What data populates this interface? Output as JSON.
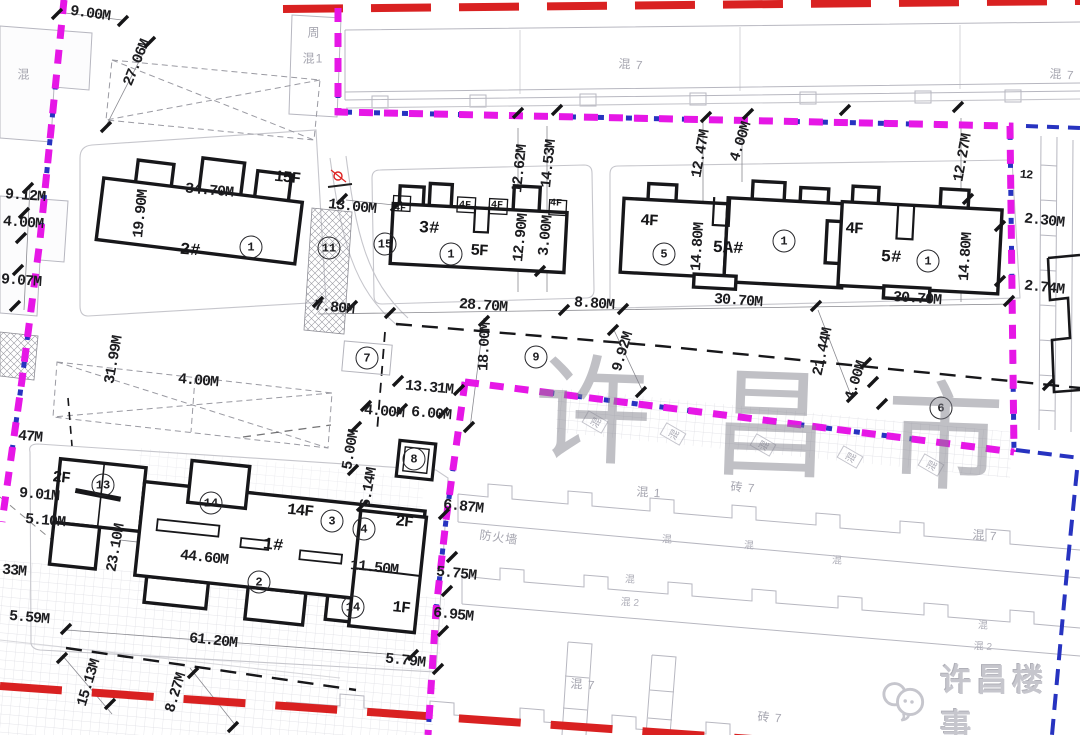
{
  "colors": {
    "boundary_magenta": "#e617e6",
    "boundary_blue": "#2733c0",
    "road_red": "#d92121",
    "drawing_black": "#17171a",
    "existing_gray": "#b4b4bc",
    "watermark_gray": "rgba(130,130,140,0.5)"
  },
  "watermark": {
    "text": "许昌市"
  },
  "logo": {
    "text": "许昌楼事",
    "icon": "chat-bubbles-icon"
  },
  "buildings": [
    {
      "number": "1#",
      "floors": [
        "14F",
        "2F",
        "1F"
      ],
      "length": "61.20M",
      "width": "23.10M"
    },
    {
      "number": "2#",
      "floors": [
        "15F"
      ],
      "length": "34.70M",
      "width": "19.90M"
    },
    {
      "number": "3#",
      "floors": [
        "5F",
        "4F"
      ],
      "length": "28.70M",
      "width": "12.90M"
    },
    {
      "number": "5A#",
      "floors": [
        "4F"
      ],
      "length": "30.70M",
      "width": "14.80M"
    },
    {
      "number": "5#",
      "floors": [
        "4F"
      ],
      "length": "30.70M",
      "width": "14.80M"
    }
  ],
  "plan": {
    "labels": [
      {
        "t": "9.00M",
        "x": 90,
        "y": 14,
        "r": 8,
        "c": "dim"
      },
      {
        "t": "27.06M",
        "x": 137,
        "y": 63,
        "r": -68,
        "c": "dim"
      },
      {
        "t": "9.12M",
        "x": 25,
        "y": 196,
        "r": 4,
        "c": "dim"
      },
      {
        "t": "4.00M",
        "x": 23,
        "y": 223,
        "r": 4,
        "c": "dim"
      },
      {
        "t": "9.07M",
        "x": 21,
        "y": 281,
        "r": 4,
        "c": "dim"
      },
      {
        "t": "19.90M",
        "x": 141,
        "y": 214,
        "r": -84,
        "c": "dim"
      },
      {
        "t": "34.70M",
        "x": 209,
        "y": 191,
        "r": 5,
        "c": "dim"
      },
      {
        "t": "15F",
        "x": 287,
        "y": 178,
        "r": 6,
        "c": "floor"
      },
      {
        "t": "2#",
        "x": 190,
        "y": 251,
        "r": 5,
        "c": "bld"
      },
      {
        "t": "13.00M",
        "x": 352,
        "y": 207,
        "r": 6,
        "c": "dim"
      },
      {
        "t": "7.80M",
        "x": 334,
        "y": 308,
        "r": 6,
        "c": "dim"
      },
      {
        "t": "3#",
        "x": 429,
        "y": 229,
        "r": 3,
        "c": "bld"
      },
      {
        "t": "5F",
        "x": 479,
        "y": 251,
        "r": 3,
        "c": "floor"
      },
      {
        "t": "4F",
        "x": 400,
        "y": 209,
        "r": 3,
        "c": "f4"
      },
      {
        "t": "4F",
        "x": 465,
        "y": 206,
        "r": 3,
        "c": "f4"
      },
      {
        "t": "4F",
        "x": 497,
        "y": 206,
        "r": 3,
        "c": "f4"
      },
      {
        "t": "4F",
        "x": 556,
        "y": 204,
        "r": 3,
        "c": "f4"
      },
      {
        "t": "12.62M",
        "x": 520,
        "y": 169,
        "r": -84,
        "c": "dim"
      },
      {
        "t": "14.53M",
        "x": 549,
        "y": 164,
        "r": -84,
        "c": "dim"
      },
      {
        "t": "12.90M",
        "x": 521,
        "y": 238,
        "r": -84,
        "c": "dim"
      },
      {
        "t": "3.00M",
        "x": 546,
        "y": 236,
        "r": -84,
        "c": "dim"
      },
      {
        "t": "28.70M",
        "x": 483,
        "y": 306,
        "r": 4,
        "c": "dim"
      },
      {
        "t": "8.80M",
        "x": 594,
        "y": 304,
        "r": 4,
        "c": "dim"
      },
      {
        "t": "12.47M",
        "x": 701,
        "y": 154,
        "r": -80,
        "c": "dim"
      },
      {
        "t": "4.00M",
        "x": 741,
        "y": 142,
        "r": -72,
        "c": "dim"
      },
      {
        "t": "4F",
        "x": 649,
        "y": 221,
        "r": 3,
        "c": "floor"
      },
      {
        "t": "5A#",
        "x": 728,
        "y": 249,
        "r": 3,
        "c": "bld"
      },
      {
        "t": "14.80M",
        "x": 698,
        "y": 247,
        "r": -86,
        "c": "dim"
      },
      {
        "t": "30.70M",
        "x": 738,
        "y": 301,
        "r": 4,
        "c": "dim"
      },
      {
        "t": "4F",
        "x": 854,
        "y": 229,
        "r": 3,
        "c": "floor"
      },
      {
        "t": "5#",
        "x": 891,
        "y": 258,
        "r": 3,
        "c": "bld"
      },
      {
        "t": "14.80M",
        "x": 966,
        "y": 257,
        "r": -86,
        "c": "dim"
      },
      {
        "t": "12.27M",
        "x": 963,
        "y": 158,
        "r": -80,
        "c": "dim"
      },
      {
        "t": "30.70M",
        "x": 917,
        "y": 299,
        "r": 4,
        "c": "dim"
      },
      {
        "t": "2.30M",
        "x": 1044,
        "y": 221,
        "r": 6,
        "c": "dim"
      },
      {
        "t": "2.74M",
        "x": 1044,
        "y": 288,
        "r": 6,
        "c": "dim"
      },
      {
        "t": "12",
        "x": 1026,
        "y": 175,
        "r": 5,
        "c": "dimsm"
      },
      {
        "t": "18.00M",
        "x": 485,
        "y": 347,
        "r": -87,
        "c": "dim"
      },
      {
        "t": "9.92M",
        "x": 623,
        "y": 352,
        "r": -73,
        "c": "dim"
      },
      {
        "t": "21.44M",
        "x": 823,
        "y": 352,
        "r": -78,
        "c": "dim"
      },
      {
        "t": "4.00M",
        "x": 856,
        "y": 381,
        "r": -72,
        "c": "dim"
      },
      {
        "t": "13.31M",
        "x": 429,
        "y": 388,
        "r": 5,
        "c": "dim"
      },
      {
        "t": "31.99M",
        "x": 114,
        "y": 360,
        "r": -80,
        "c": "dim"
      },
      {
        "t": "4.00M",
        "x": 198,
        "y": 381,
        "r": 5,
        "c": "dim"
      },
      {
        "t": "47M",
        "x": 30,
        "y": 437,
        "r": 5,
        "c": "dim"
      },
      {
        "t": "4.00M",
        "x": 384,
        "y": 412,
        "r": 5,
        "c": "dim"
      },
      {
        "t": "6.00M",
        "x": 431,
        "y": 414,
        "r": 5,
        "c": "dim"
      },
      {
        "t": "5.00M",
        "x": 351,
        "y": 450,
        "r": -80,
        "c": "dim"
      },
      {
        "t": "6.14M",
        "x": 369,
        "y": 488,
        "r": -80,
        "c": "dim"
      },
      {
        "t": "6.87M",
        "x": 463,
        "y": 507,
        "r": 6,
        "c": "dim"
      },
      {
        "t": "防火墙",
        "x": 499,
        "y": 537,
        "r": 8,
        "c": "gray"
      },
      {
        "t": "5.75M",
        "x": 456,
        "y": 574,
        "r": 6,
        "c": "dim"
      },
      {
        "t": "6.95M",
        "x": 453,
        "y": 615,
        "r": 6,
        "c": "dim"
      },
      {
        "t": "5.79M",
        "x": 405,
        "y": 661,
        "r": 6,
        "c": "dim"
      },
      {
        "t": "2F",
        "x": 61,
        "y": 478,
        "r": 6,
        "c": "floor"
      },
      {
        "t": "9.01M",
        "x": 39,
        "y": 495,
        "r": 5,
        "c": "dim"
      },
      {
        "t": "5.10M",
        "x": 45,
        "y": 521,
        "r": 5,
        "c": "dim"
      },
      {
        "t": "33M",
        "x": 14,
        "y": 571,
        "r": 5,
        "c": "dim"
      },
      {
        "t": "5.59M",
        "x": 29,
        "y": 618,
        "r": 5,
        "c": "dim"
      },
      {
        "t": "23.10M",
        "x": 116,
        "y": 548,
        "r": -80,
        "c": "dim"
      },
      {
        "t": "14F",
        "x": 300,
        "y": 511,
        "r": 6,
        "c": "floor"
      },
      {
        "t": "2F",
        "x": 404,
        "y": 522,
        "r": 6,
        "c": "floor"
      },
      {
        "t": "1#",
        "x": 273,
        "y": 546,
        "r": 6,
        "c": "bld"
      },
      {
        "t": "44.60M",
        "x": 204,
        "y": 558,
        "r": 6,
        "c": "dim"
      },
      {
        "t": "11.50M",
        "x": 374,
        "y": 568,
        "r": 6,
        "c": "dim"
      },
      {
        "t": "1F",
        "x": 401,
        "y": 608,
        "r": 6,
        "c": "floor"
      },
      {
        "t": "61.20M",
        "x": 213,
        "y": 641,
        "r": 6,
        "c": "dim"
      },
      {
        "t": "15.13M",
        "x": 89,
        "y": 683,
        "r": -73,
        "c": "dim"
      },
      {
        "t": "8.27M",
        "x": 176,
        "y": 693,
        "r": -73,
        "c": "dim"
      },
      {
        "t": "1",
        "x": 251,
        "y": 247,
        "r": 0,
        "c": "circ"
      },
      {
        "t": "11",
        "x": 329,
        "y": 248,
        "r": 0,
        "c": "circ"
      },
      {
        "t": "15",
        "x": 385,
        "y": 244,
        "r": 0,
        "c": "circ"
      },
      {
        "t": "1",
        "x": 451,
        "y": 254,
        "r": 0,
        "c": "circ"
      },
      {
        "t": "5",
        "x": 664,
        "y": 254,
        "r": 0,
        "c": "circ"
      },
      {
        "t": "1",
        "x": 784,
        "y": 241,
        "r": 0,
        "c": "circ"
      },
      {
        "t": "1",
        "x": 928,
        "y": 261,
        "r": 0,
        "c": "circ"
      },
      {
        "t": "7",
        "x": 367,
        "y": 358,
        "r": 0,
        "c": "circ"
      },
      {
        "t": "9",
        "x": 536,
        "y": 357,
        "r": 0,
        "c": "circ"
      },
      {
        "t": "8",
        "x": 414,
        "y": 459,
        "r": 0,
        "c": "circ"
      },
      {
        "t": "6",
        "x": 941,
        "y": 408,
        "r": 0,
        "c": "circ"
      },
      {
        "t": "13",
        "x": 103,
        "y": 485,
        "r": 0,
        "c": "circ"
      },
      {
        "t": "14",
        "x": 211,
        "y": 503,
        "r": 0,
        "c": "circ"
      },
      {
        "t": "3",
        "x": 332,
        "y": 521,
        "r": 0,
        "c": "circ"
      },
      {
        "t": "4",
        "x": 364,
        "y": 529,
        "r": 0,
        "c": "circ"
      },
      {
        "t": "2",
        "x": 259,
        "y": 582,
        "r": 0,
        "c": "circ"
      },
      {
        "t": "14",
        "x": 353,
        "y": 607,
        "r": 0,
        "c": "circ"
      },
      {
        "t": "周",
        "x": 314,
        "y": 32,
        "r": 0,
        "c": "gray"
      },
      {
        "t": "混1",
        "x": 313,
        "y": 58,
        "r": 0,
        "c": "gray"
      },
      {
        "t": "混",
        "x": 24,
        "y": 74,
        "r": 0,
        "c": "gray"
      },
      {
        "t": "混 7",
        "x": 631,
        "y": 64,
        "r": 4,
        "c": "gray"
      },
      {
        "t": "混 7",
        "x": 1062,
        "y": 74,
        "r": 4,
        "c": "gray"
      },
      {
        "t": "混",
        "x": 595,
        "y": 422,
        "r": -60,
        "c": "graybox"
      },
      {
        "t": "混",
        "x": 673,
        "y": 434,
        "r": -60,
        "c": "graybox"
      },
      {
        "t": "混",
        "x": 763,
        "y": 445,
        "r": -60,
        "c": "graybox"
      },
      {
        "t": "混",
        "x": 850,
        "y": 457,
        "r": -60,
        "c": "graybox"
      },
      {
        "t": "混",
        "x": 931,
        "y": 465,
        "r": -60,
        "c": "graybox"
      },
      {
        "t": "混 1",
        "x": 649,
        "y": 492,
        "r": 4,
        "c": "gray"
      },
      {
        "t": "砖 7",
        "x": 743,
        "y": 487,
        "r": 4,
        "c": "gray"
      },
      {
        "t": "混 7",
        "x": 985,
        "y": 535,
        "r": 4,
        "c": "gray"
      },
      {
        "t": "混",
        "x": 667,
        "y": 538,
        "r": 4,
        "c": "graysm"
      },
      {
        "t": "混",
        "x": 749,
        "y": 544,
        "r": 4,
        "c": "graysm"
      },
      {
        "t": "混",
        "x": 837,
        "y": 559,
        "r": 4,
        "c": "graysm"
      },
      {
        "t": "混",
        "x": 630,
        "y": 578,
        "r": 4,
        "c": "graysm"
      },
      {
        "t": "混 2",
        "x": 630,
        "y": 601,
        "r": 4,
        "c": "graysm"
      },
      {
        "t": "混",
        "x": 983,
        "y": 624,
        "r": 4,
        "c": "graysm"
      },
      {
        "t": "混 2",
        "x": 983,
        "y": 645,
        "r": 4,
        "c": "graysm"
      },
      {
        "t": "混 7",
        "x": 583,
        "y": 684,
        "r": 4,
        "c": "gray"
      },
      {
        "t": "砖 7",
        "x": 770,
        "y": 717,
        "r": 4,
        "c": "gray"
      },
      {
        "t": "许",
        "x": 593,
        "y": 402,
        "r": 2,
        "c": "wm"
      },
      {
        "t": "昌",
        "x": 771,
        "y": 415,
        "r": 2,
        "c": "wm"
      },
      {
        "t": "市",
        "x": 945,
        "y": 428,
        "r": 2,
        "c": "wm"
      }
    ]
  }
}
